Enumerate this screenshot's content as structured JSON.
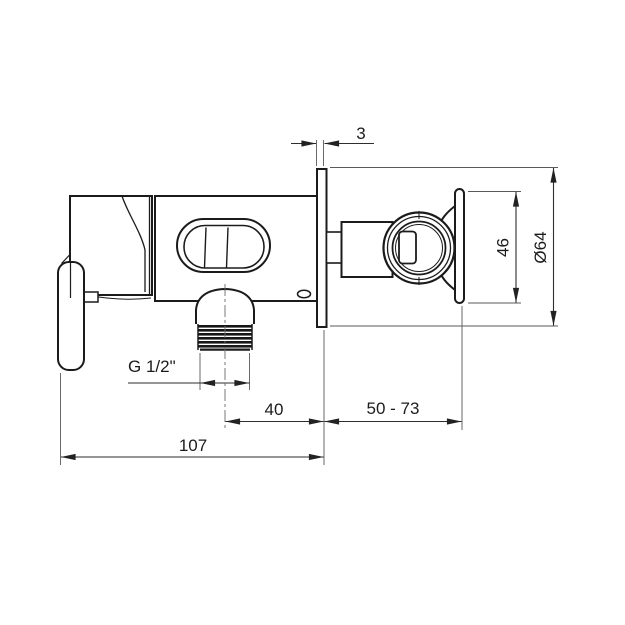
{
  "drawing": {
    "dimensions": {
      "plate_thickness": "3",
      "holder_height": "46",
      "rosette_diameter": "Ø64",
      "outlet_thread": "G 1/2\"",
      "outlet_to_wall": "40",
      "installation_depth_range": "50 - 73",
      "body_length": "107"
    },
    "colors": {
      "line": "#1b1b1b",
      "dimension_line": "#2e2e2e",
      "background": "#ffffff"
    }
  }
}
